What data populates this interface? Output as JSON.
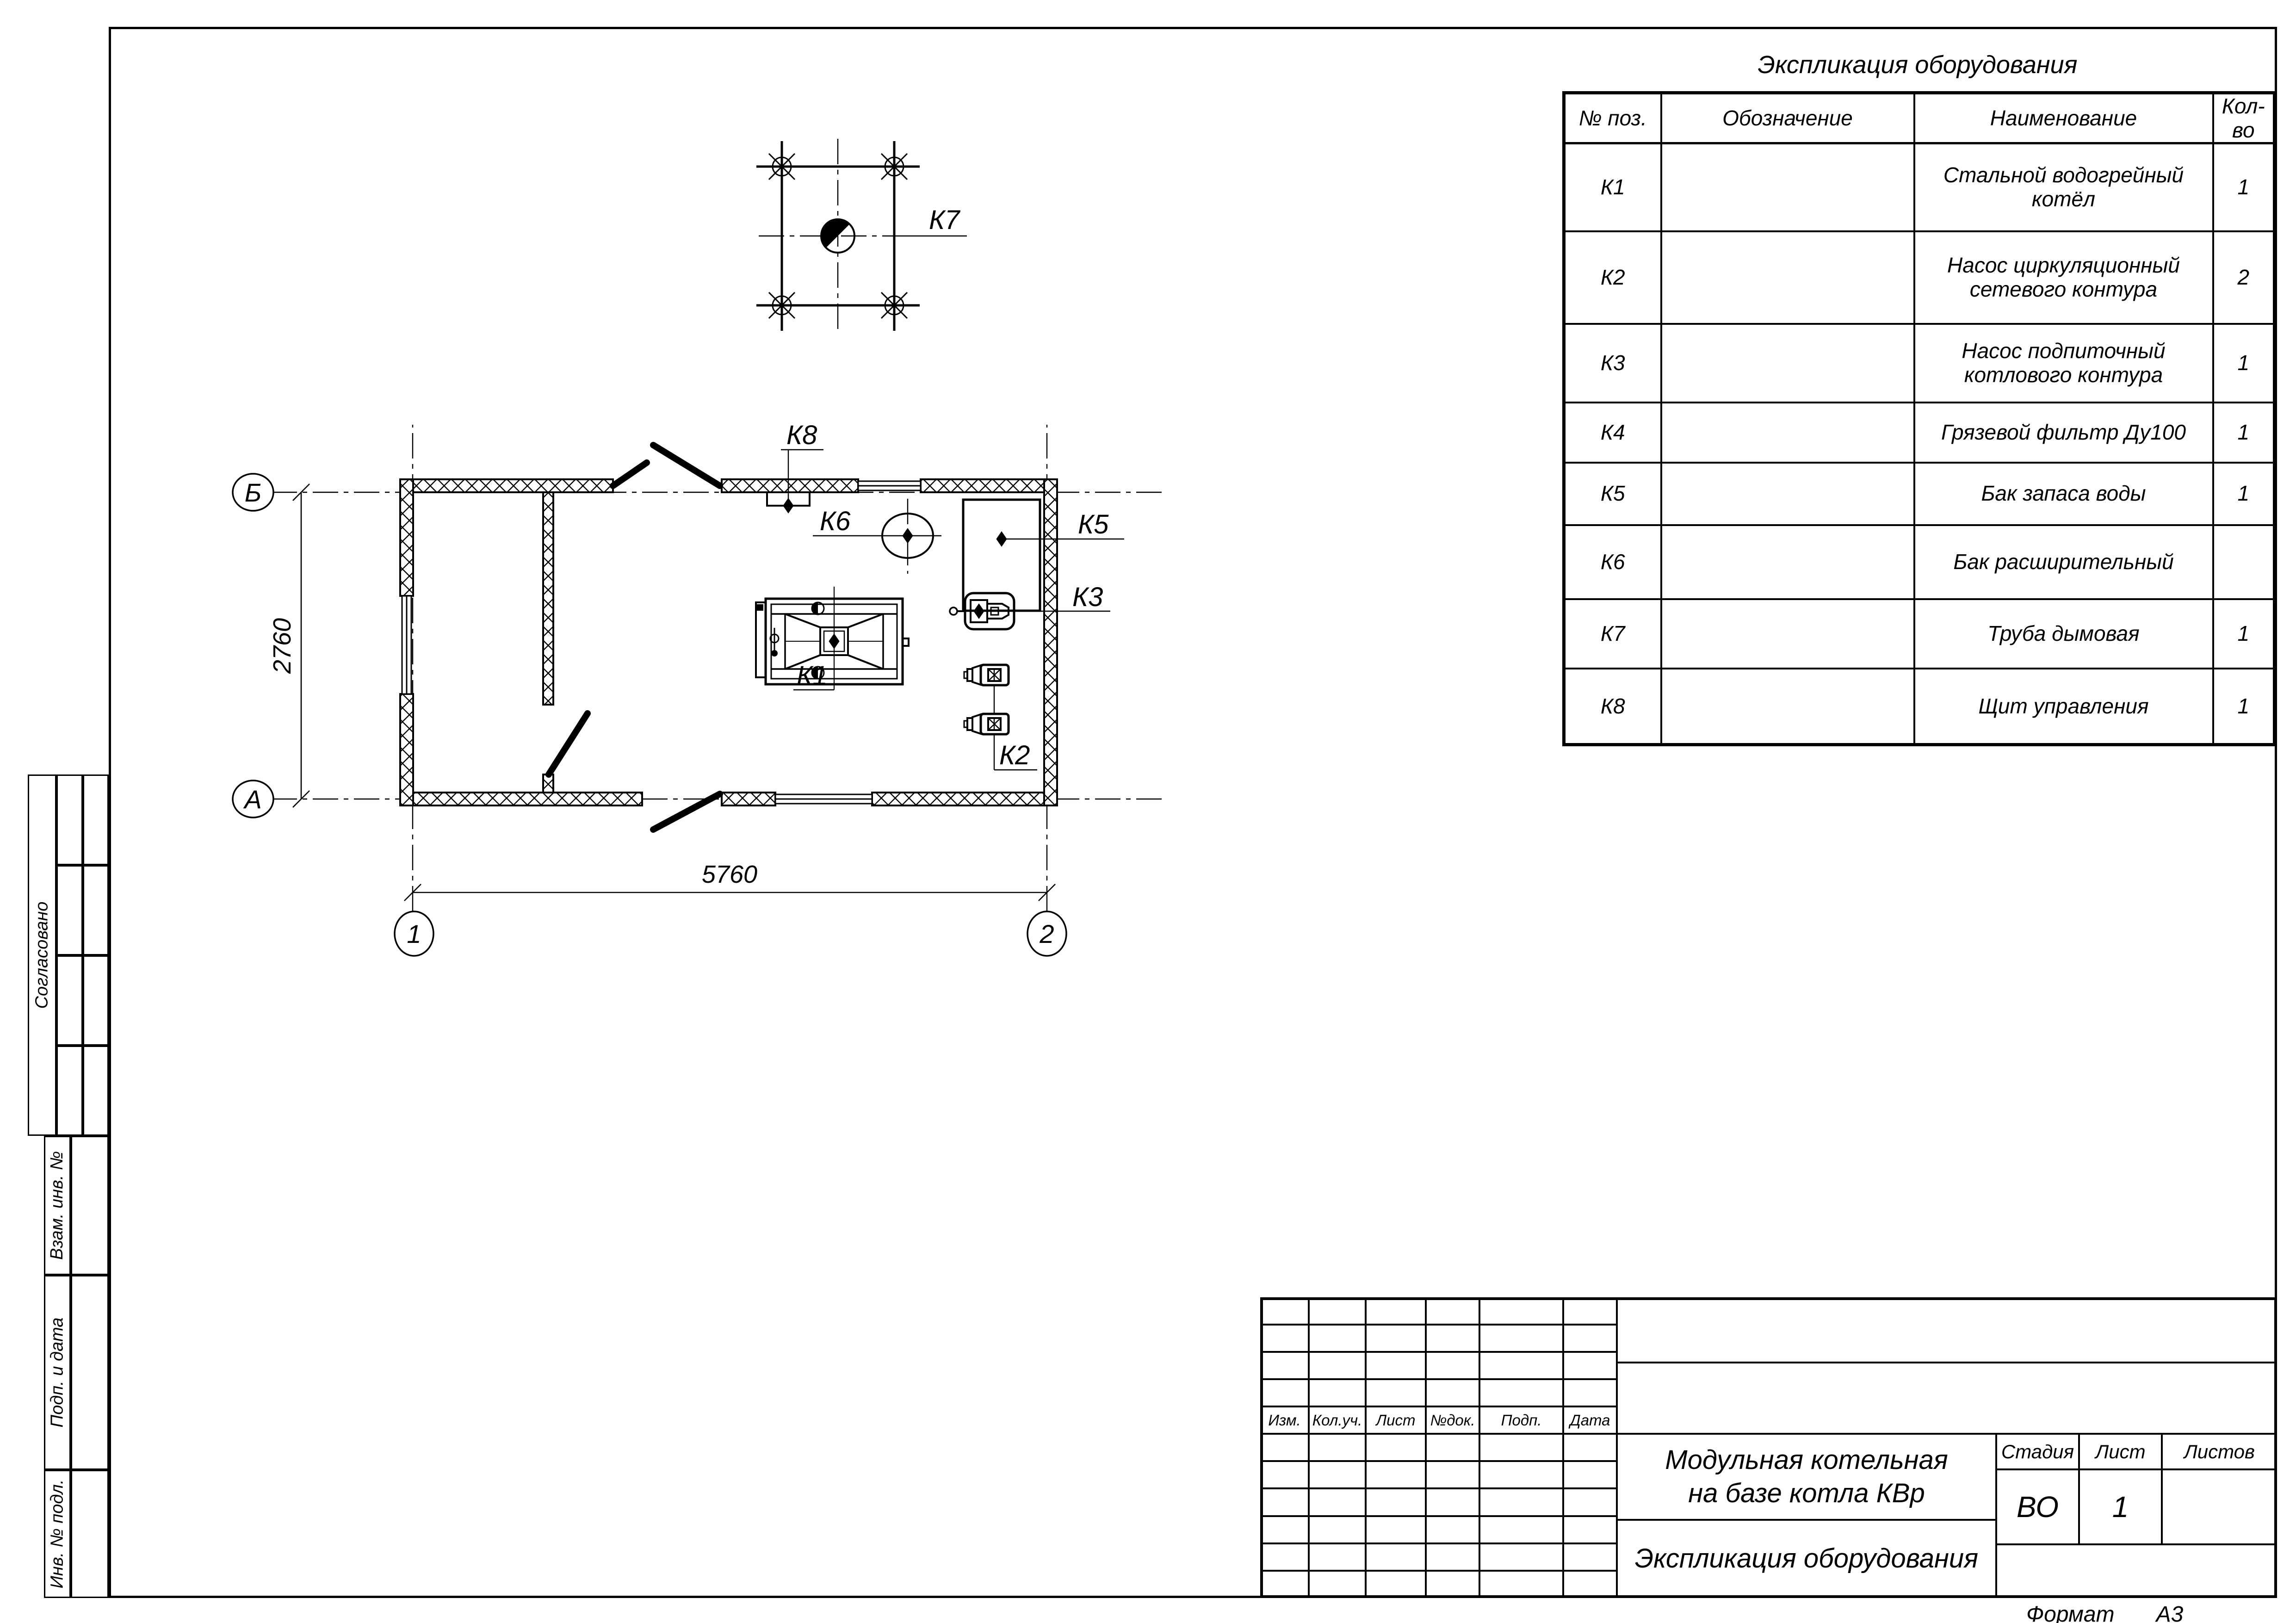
{
  "sheet": {
    "format_label": "Формат",
    "format_value": "А3"
  },
  "equip_table": {
    "title": "Экспликация оборудования",
    "headers": {
      "pos": "№ поз.",
      "designation": "Обозначение",
      "name": "Наименование",
      "qty": "Кол-во"
    },
    "rows": [
      {
        "pos": "К1",
        "designation": "",
        "name": "Стальной водогрейный котёл",
        "qty": "1"
      },
      {
        "pos": "К2",
        "designation": "",
        "name": "Насос циркуляционный сетевого контура",
        "qty": "2"
      },
      {
        "pos": "К3",
        "designation": "",
        "name": "Насос подпиточный котлового контура",
        "qty": "1"
      },
      {
        "pos": "К4",
        "designation": "",
        "name": "Грязевой фильтр Ду100",
        "qty": "1"
      },
      {
        "pos": "К5",
        "designation": "",
        "name": "Бак запаса воды",
        "qty": "1"
      },
      {
        "pos": "К6",
        "designation": "",
        "name": "Бак расширительный",
        "qty": ""
      },
      {
        "pos": "К7",
        "designation": "",
        "name": "Труба дымовая",
        "qty": "1"
      },
      {
        "pos": "К8",
        "designation": "",
        "name": "Щит управления",
        "qty": "1"
      }
    ]
  },
  "plan": {
    "labels": {
      "k1": "К1",
      "k2": "К2",
      "k3": "К3",
      "k5": "К5",
      "k6": "К6",
      "k7": "К7",
      "k8": "К8"
    },
    "axes": {
      "a": "А",
      "b": "Б",
      "n1": "1",
      "n2": "2"
    },
    "dims": {
      "width": "5760",
      "height": "2760"
    }
  },
  "title_block": {
    "project_line1": "Модульная котельная",
    "project_line2": "на базе котла КВр",
    "doc_name": "Экспликация оборудования",
    "stage_label": "Стадия",
    "stage_value": "ВО",
    "sheet_label": "Лист",
    "sheet_value": "1",
    "sheets_label": "Листов",
    "columns": [
      "Изм.",
      "Кол.уч.",
      "Лист",
      "№док.",
      "Подп.",
      "Дата"
    ]
  },
  "sidebar": {
    "items": [
      "Согласовано",
      "Взам. инв. №",
      "Подп. и дата",
      "Инв. № подл."
    ]
  }
}
